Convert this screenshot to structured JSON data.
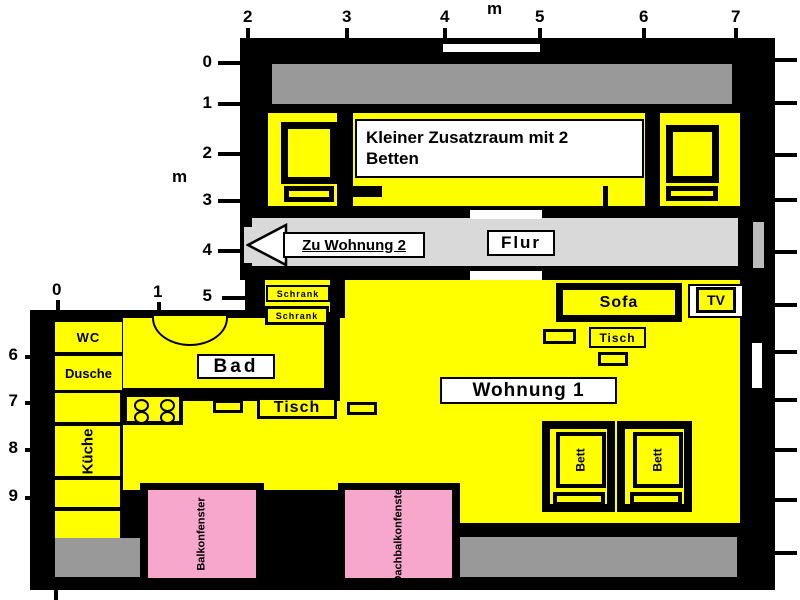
{
  "rulers": {
    "top": {
      "unit": "m",
      "values": [
        "2",
        "3",
        "4",
        "5",
        "6",
        "7"
      ]
    },
    "left_upper": {
      "unit": "m",
      "values": [
        "0",
        "1",
        "2",
        "3",
        "4",
        "5"
      ]
    },
    "left_lower": {
      "values": [
        "6",
        "7",
        "8",
        "9"
      ]
    },
    "inner": {
      "values": [
        "0",
        "1"
      ]
    }
  },
  "upper_unit": {
    "room_label": "Kleiner Zusatzraum mit 2 Betten",
    "corridor_label": "Flur",
    "exit_label": "Zu Wohnung 2"
  },
  "apartment": {
    "title": "Wohnung 1",
    "rooms": {
      "wc": "WC",
      "shower": "Dusche",
      "bath": "Bad",
      "kitchen": "Küche"
    },
    "furniture": {
      "sofa": "Sofa",
      "tv": "TV",
      "table_living": "Tisch",
      "table_dining": "Tisch",
      "wardrobe_1": "Schrank",
      "wardrobe_2": "Schrank",
      "bed_1": "Bett",
      "bed_2": "Bett"
    },
    "windows": {
      "balcony_window": "Balkonfenster",
      "roof_balcony_window": "Dachbalkonfenster"
    }
  },
  "colors": {
    "room_fill": "#ffff00",
    "wall": "#000000",
    "terrace": "#999999",
    "corridor": "#d9d9d9",
    "window": "#f7a6cc",
    "label_bg": "#ffffff"
  }
}
